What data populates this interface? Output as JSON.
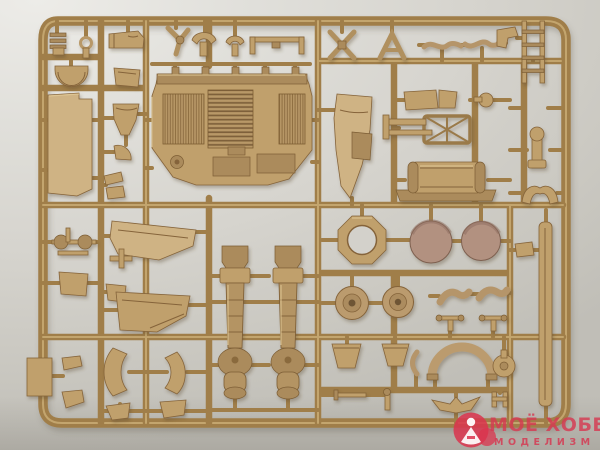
{
  "meta": {
    "media_type": "photograph",
    "subject": "Tan injection-molded plastic model kit sprue (parts tree) lying on a light grey surface"
  },
  "palette": {
    "background": "#d9d7d2",
    "background_shadow": "#c0beb7",
    "plastic_runner": "#a07e49",
    "plastic_part": "#c0a06c",
    "plastic_highlight": "#cfb384",
    "plastic_dark": "#85643a",
    "hatch_disc": "#b29180",
    "watermark_red": "#d53952"
  },
  "watermark": {
    "line1": "МОЁ ХОББИ",
    "line2": "МОДЕЛИЗМ",
    "logo": "red disc with white modeller figure"
  },
  "sprue": {
    "part_names": [
      "ladder-bracket",
      "ring-pin",
      "jerry-can",
      "twist-clamp",
      "fork-mount-large",
      "fork-mount-small",
      "tow-bar",
      "x-brace",
      "a-frame",
      "s-link-left",
      "s-link-right",
      "corner-bracket",
      "ladder",
      "half-dome",
      "large-side-panel",
      "funnel-shroud",
      "fan-disc",
      "angle-bracket-pair",
      "canted-bracket",
      "engine-deck-panel",
      "fender-blade",
      "plate-pair",
      "ball-stem",
      "stowage-rack",
      "hook-bracket",
      "fuel-tank",
      "saddle-mount",
      "axle-with-rollers",
      "hull-side-panel",
      "cross-clip",
      "hatch-plate-small",
      "hatch-plate-tiny",
      "mudguard-panel",
      "edge-panel",
      "clip-upper",
      "clip-lower",
      "arc-blade-left",
      "arc-blade-right",
      "wing-fin-left",
      "wing-fin-right",
      "recoil-cylinder-left",
      "recoil-cylinder-right",
      "octagon-ring",
      "hatch-disc-left",
      "hatch-disc-right",
      "road-wheel-left",
      "road-wheel-right",
      "curved-link-left",
      "curved-link-right",
      "t-valve-left",
      "t-valve-right",
      "bucket-left",
      "bucket-right",
      "small-arc",
      "wheel-arch",
      "knob-cap",
      "tie-rod",
      "pin-post",
      "v-wing",
      "h-clamp",
      "plank-strip",
      "strip-clip"
    ]
  }
}
